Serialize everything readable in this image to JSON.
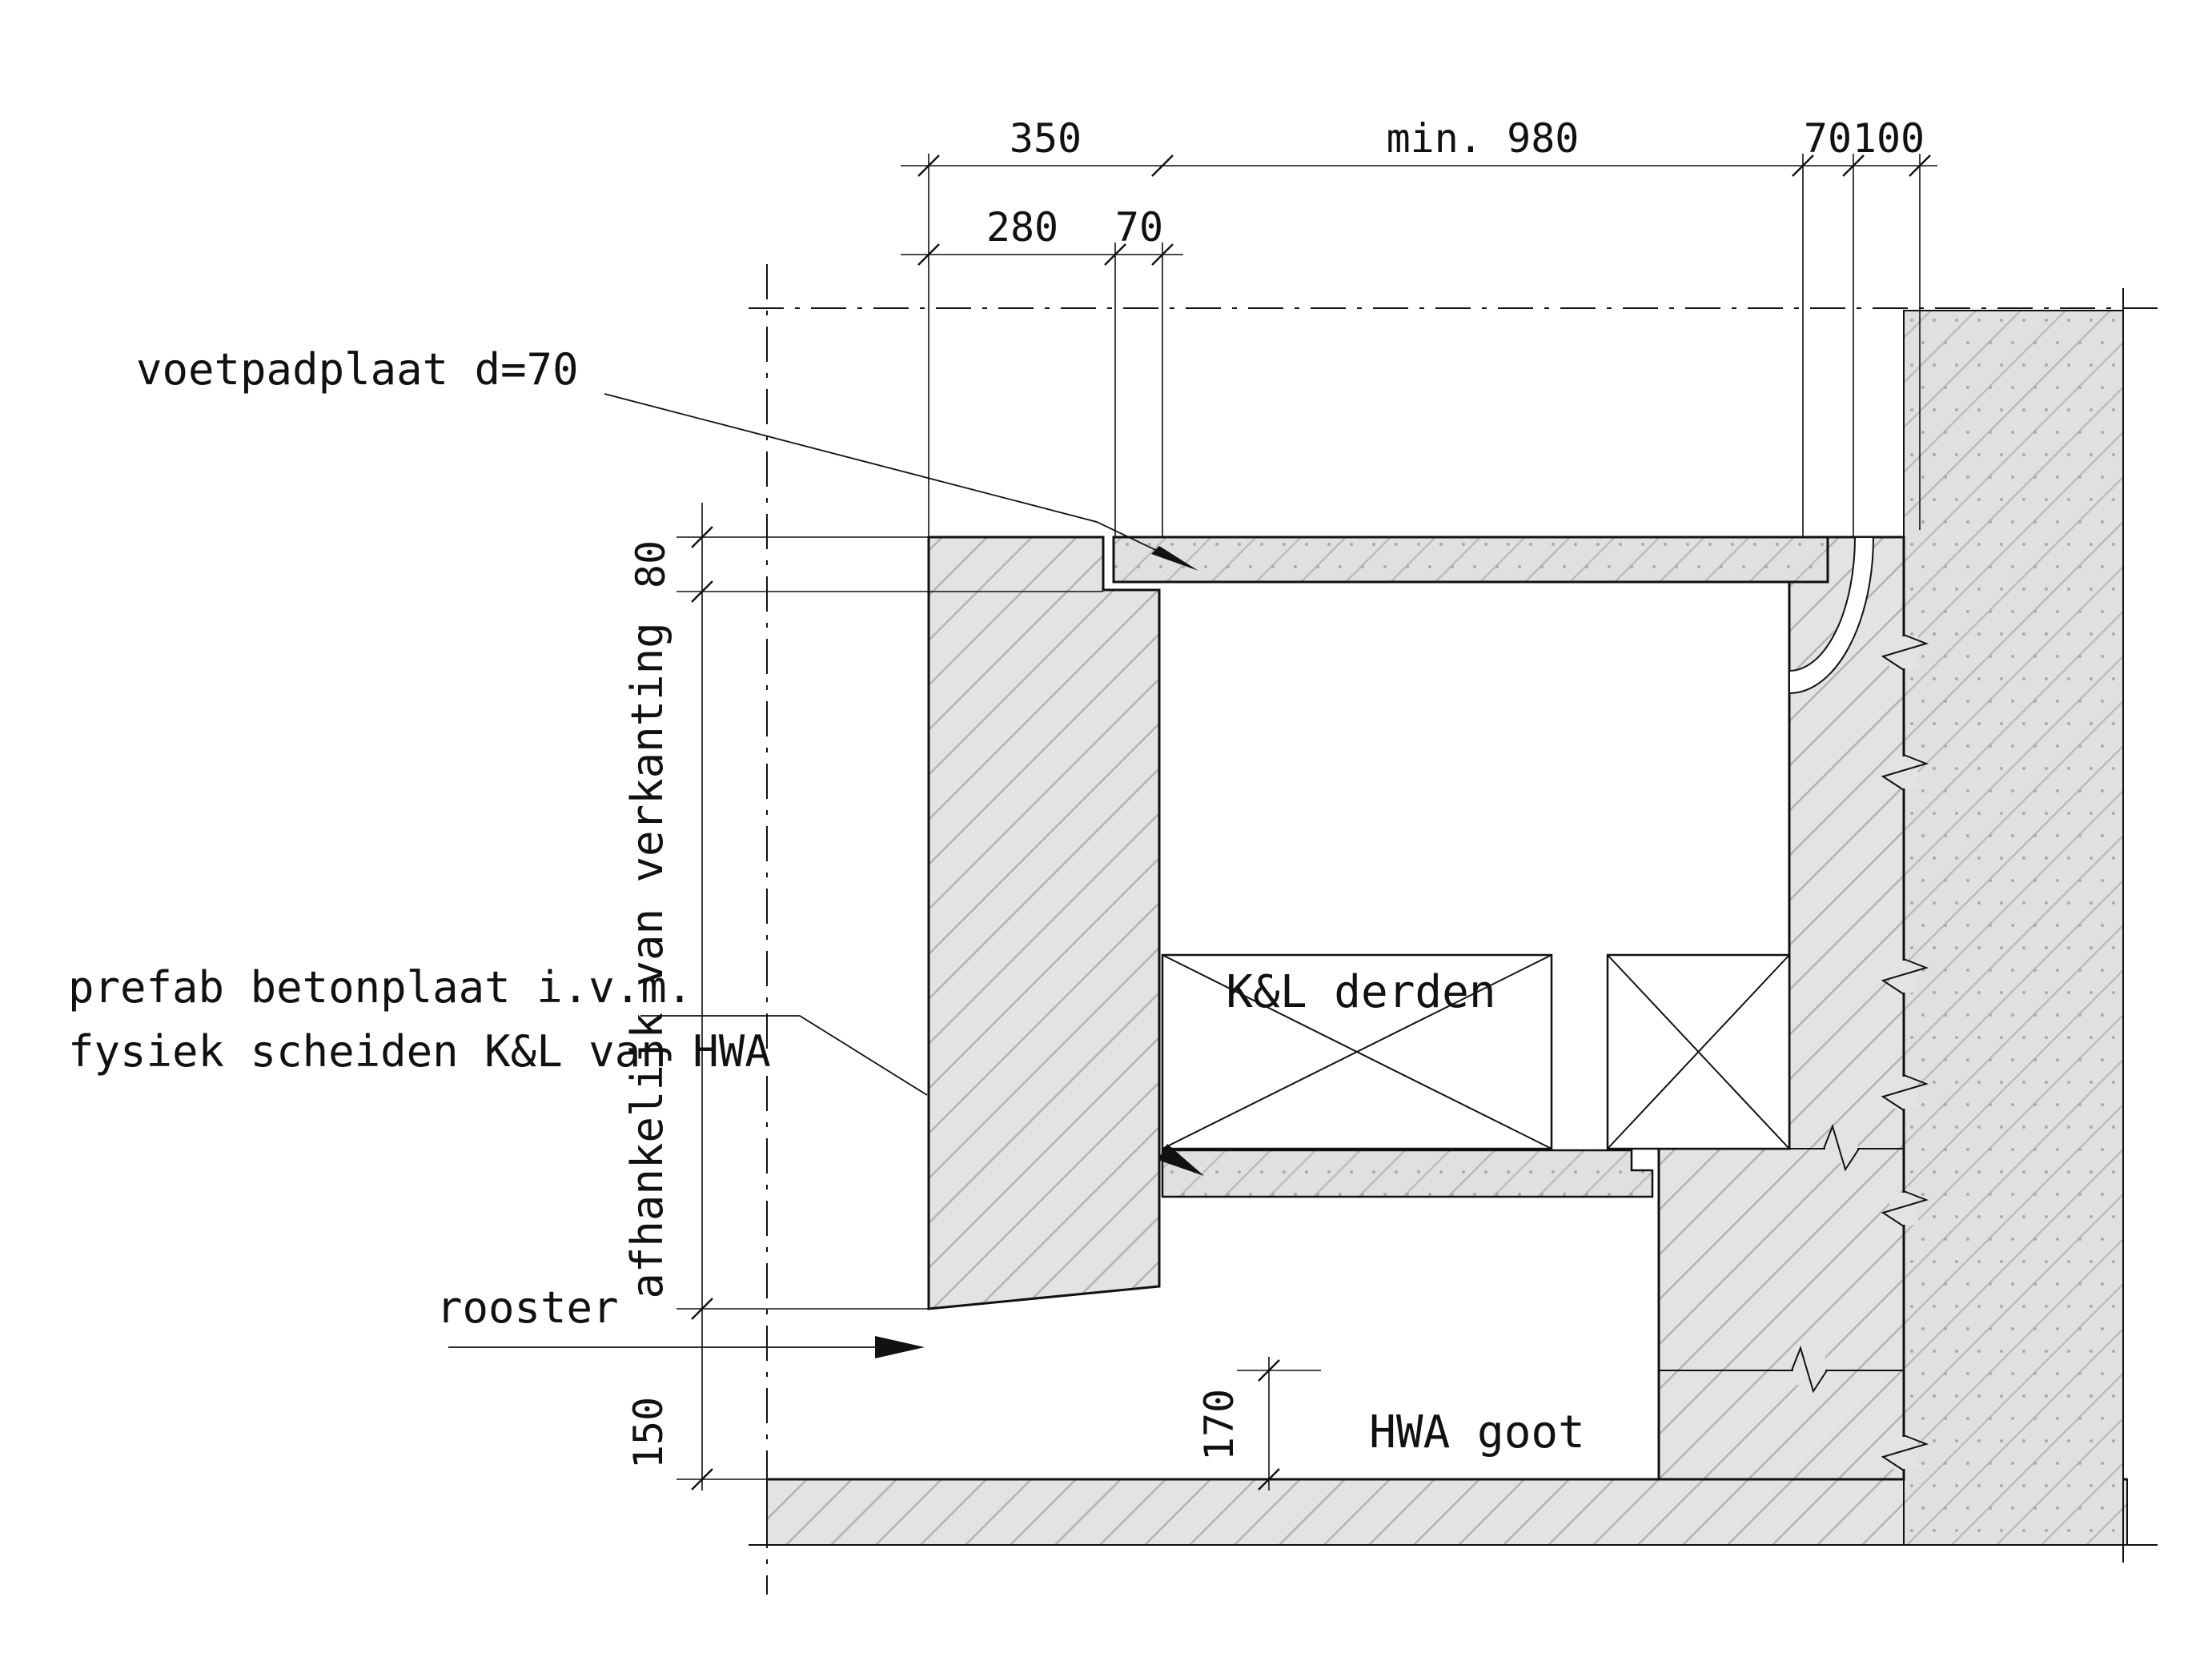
{
  "drawing": {
    "type": "construction-detail-cross-section",
    "labels": {
      "voetpadplaat": "voetpadplaat d=70",
      "prefab_line1": "prefab betonplaat i.v.m.",
      "prefab_line2": "fysiek scheiden K&L van HWA",
      "rooster": "rooster",
      "afhankelijk": "afhankelijk van verkanting",
      "kl_derden": "K&L derden",
      "hwa_goot": "HWA goot"
    },
    "dimensions": {
      "top_row": [
        {
          "label": "350"
        },
        {
          "label": "min. 980"
        },
        {
          "label": "70"
        },
        {
          "label": "100"
        }
      ],
      "second_row": [
        {
          "label": "280"
        },
        {
          "label": "70"
        }
      ],
      "left_column": [
        {
          "label": "80"
        },
        {
          "label": "150"
        }
      ],
      "gutter_depth": {
        "label": "170"
      }
    },
    "colors": {
      "concrete_fill": "#e3e3e3",
      "hatch_line": "#b3b3b3",
      "line_black": "#111111",
      "background": "#ffffff"
    }
  }
}
